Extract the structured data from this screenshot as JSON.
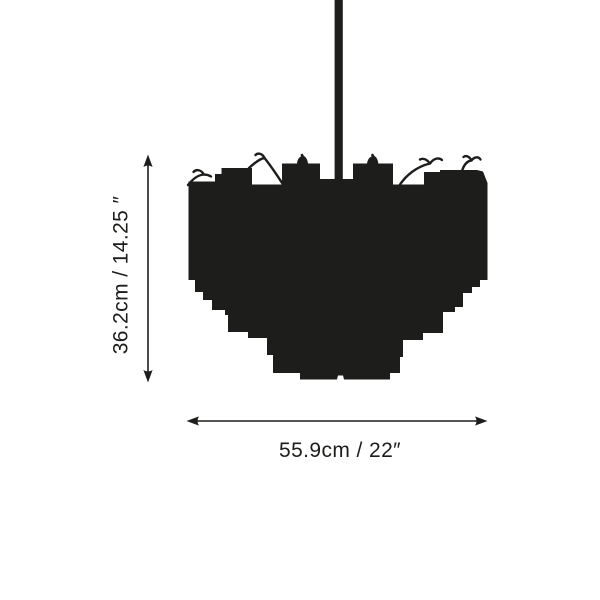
{
  "diagram": {
    "height_dimension": {
      "label": "36.2cm / 14.25 ″",
      "cm": "36.2",
      "inches": "14.25"
    },
    "width_dimension": {
      "label": "55.9cm / 22″",
      "cm": "55.9",
      "inches": "22"
    }
  },
  "colors": {
    "ink": "#1d1d1b",
    "background": "#ffffff"
  }
}
